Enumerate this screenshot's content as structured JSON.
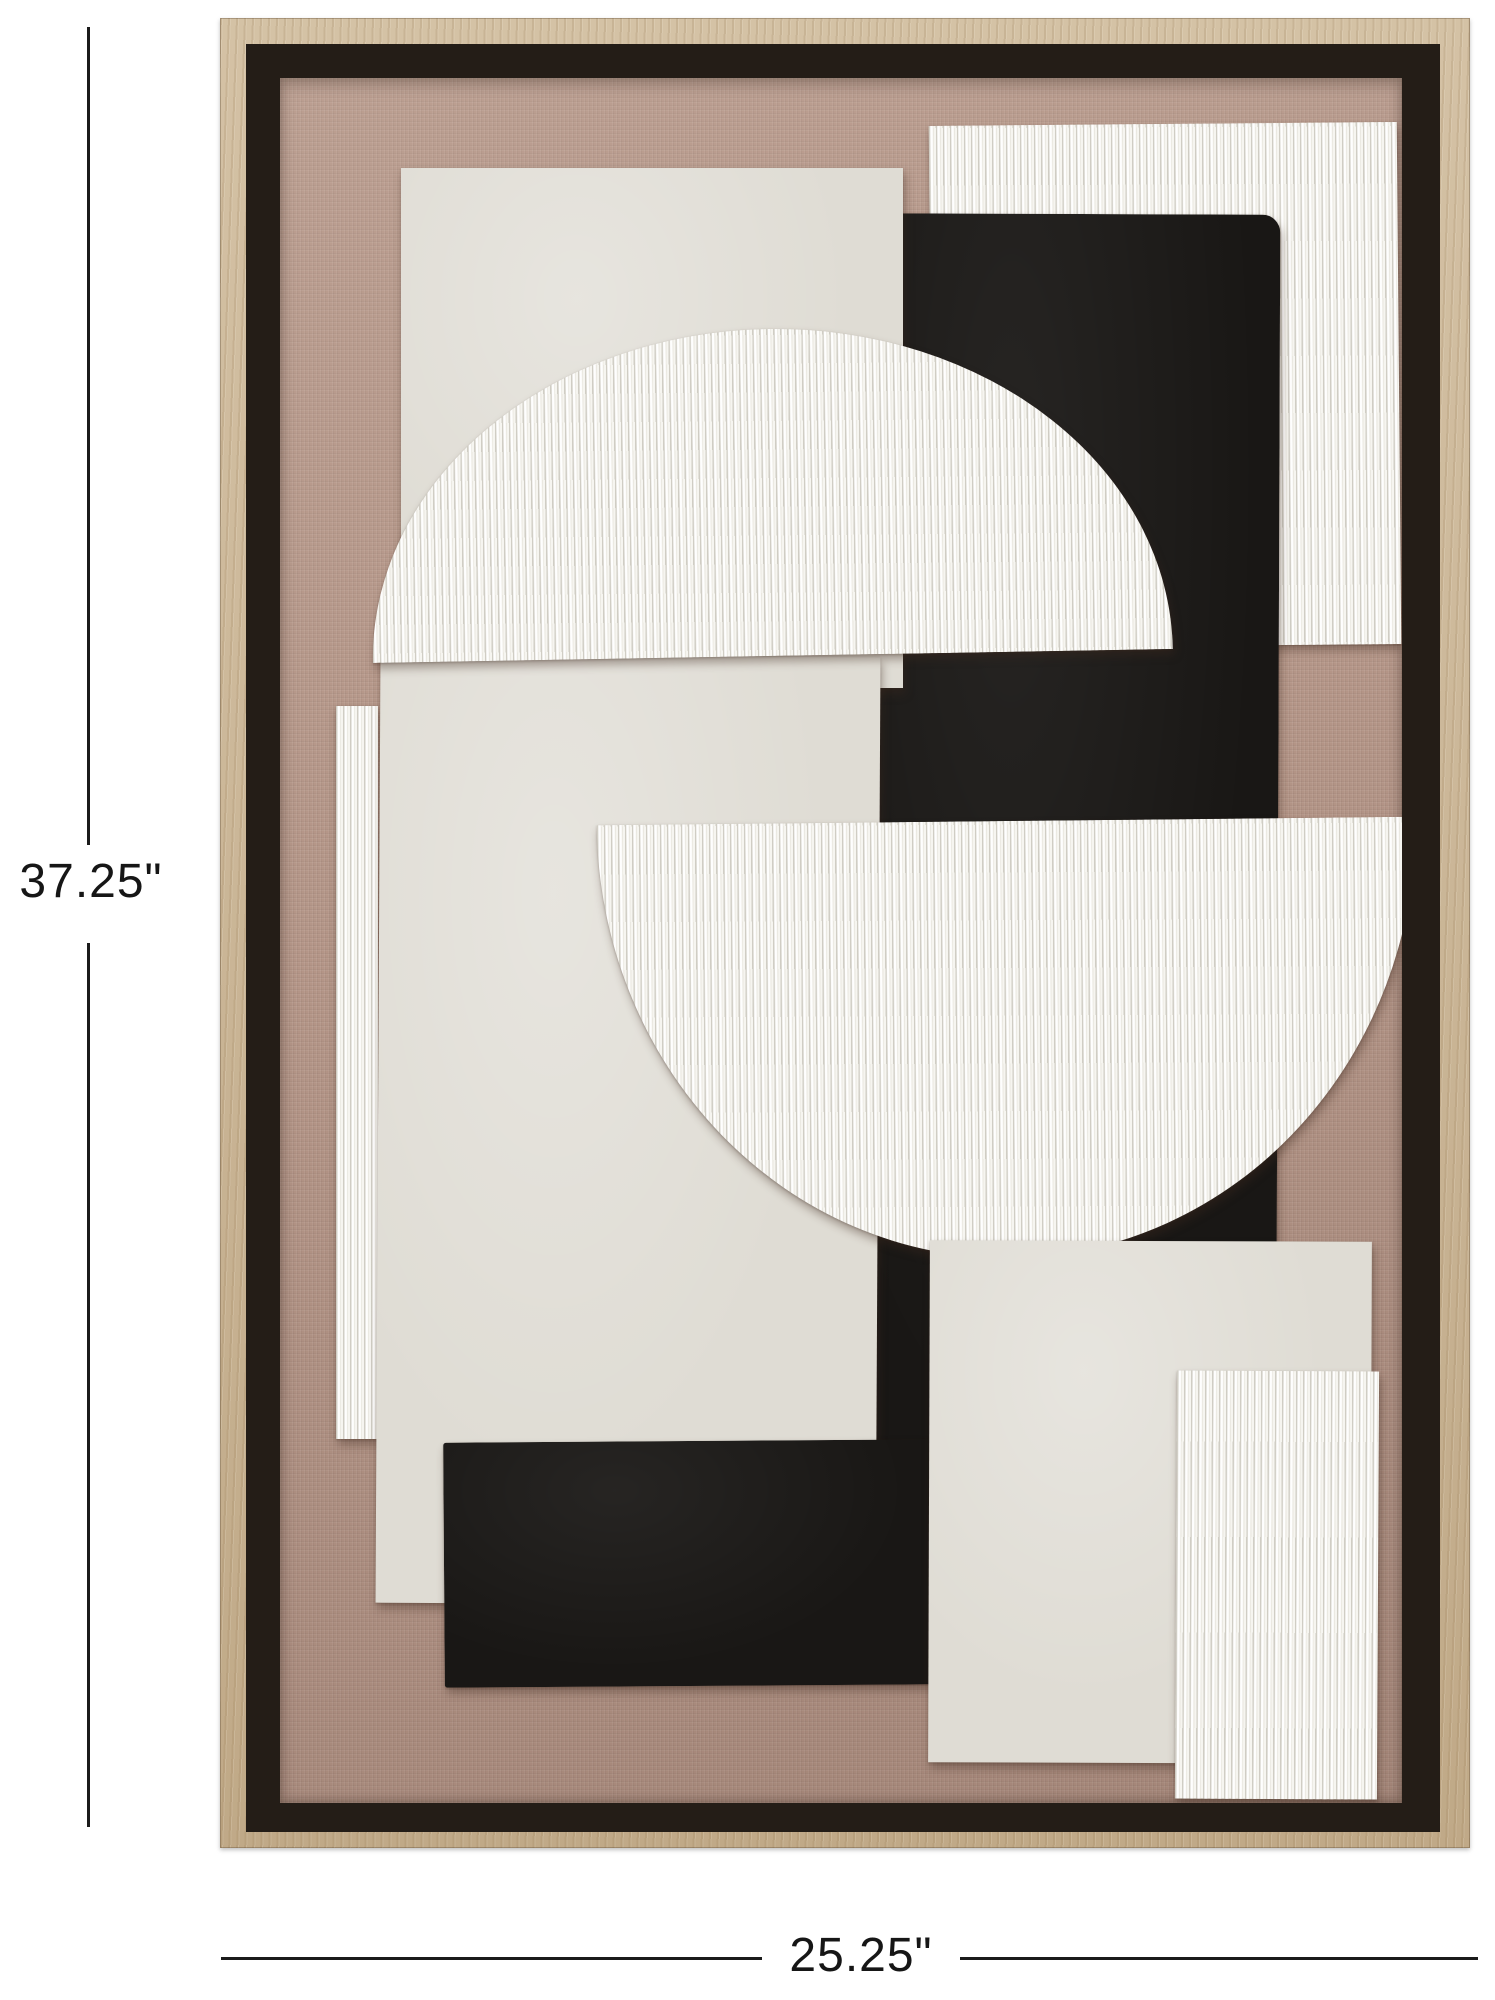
{
  "dimensions": {
    "height_label": "37.25\"",
    "width_label": "25.25\""
  },
  "colors": {
    "page_bg": "#ffffff",
    "dimension_line": "#1b1b1b",
    "dimension_text": "#161616",
    "frame_wood": "#ccb694",
    "frame_shadow": "#241d17",
    "canvas_fabric": "#b29385",
    "panel_cream": "#dfdcd4",
    "panel_black": "#191715",
    "panel_white": "#f6f5f0"
  },
  "artwork": {
    "type": "framed-abstract-relief-wall-art",
    "pieces": [
      "left-ribbed-strip",
      "top-right-ribbed-panel",
      "main-black-rectangle",
      "top-left-cream-rectangle",
      "center-cream-panel",
      "upper-white-semicircle",
      "lower-white-semicircle",
      "bottom-black-rectangle",
      "bottom-right-cream-rectangle",
      "bottom-right-ribbed-rectangle"
    ]
  }
}
